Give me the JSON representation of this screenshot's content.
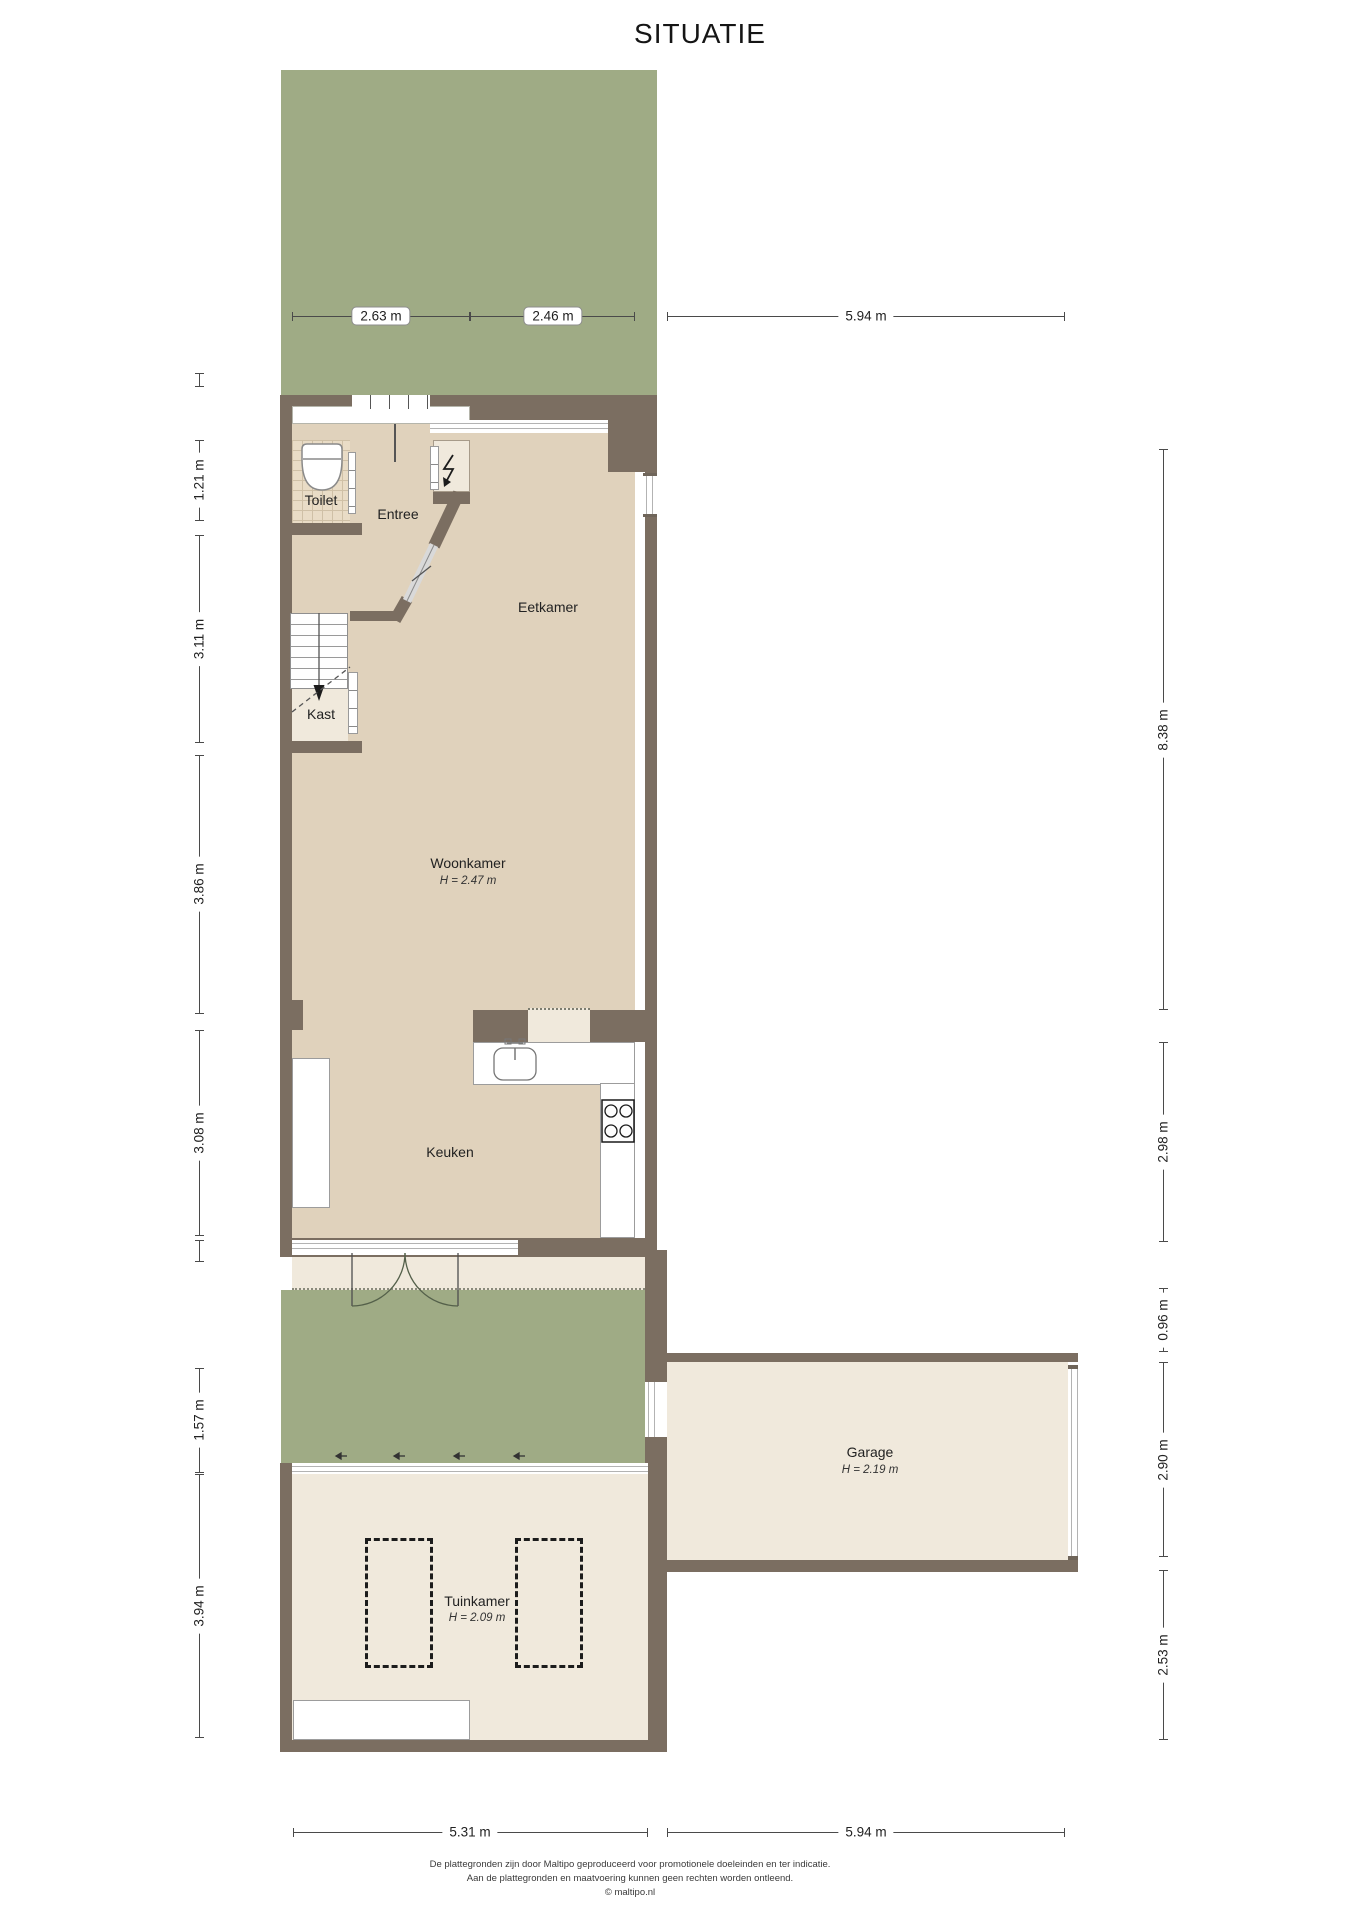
{
  "title": "SITUATIE",
  "rooms": {
    "toilet": {
      "label": "Toilet"
    },
    "entree": {
      "label": "Entree"
    },
    "eetkamer": {
      "label": "Eetkamer"
    },
    "kast": {
      "label": "Kast"
    },
    "woonkamer": {
      "label": "Woonkamer",
      "height_label": "H = 2.47 m"
    },
    "keuken": {
      "label": "Keuken"
    },
    "tuinkamer": {
      "label": "Tuinkamer",
      "height_label": "H = 2.09 m"
    },
    "garage": {
      "label": "Garage",
      "height_label": "H = 2.19 m"
    }
  },
  "dimensions": {
    "top": [
      {
        "label": "2.63 m"
      },
      {
        "label": "2.46 m"
      },
      {
        "label": "5.94 m"
      }
    ],
    "left": [
      {
        "label": "1.21 m"
      },
      {
        "label": "3.11 m"
      },
      {
        "label": "3.86 m"
      },
      {
        "label": "3.08 m"
      },
      {
        "label": "1.57 m"
      },
      {
        "label": "3.94 m"
      }
    ],
    "right": [
      {
        "label": "8.38 m"
      },
      {
        "label": "2.98 m"
      },
      {
        "label": "0.96 m"
      },
      {
        "label": "2.90 m"
      },
      {
        "label": "2.53 m"
      }
    ],
    "bottom": [
      {
        "label": "5.31 m"
      },
      {
        "label": "5.94 m"
      }
    ]
  },
  "footer": {
    "line1": "De plattegronden zijn door Maltipo geproduceerd voor promotionele doeleinden en ter indicatie.",
    "line2": "Aan de plattegronden en maatvoering kunnen geen rechten worden ontleend.",
    "line3": "© maltipo.nl"
  },
  "colors": {
    "garden_green": "#9fab85",
    "wall_brown": "#7b6e61",
    "floor_beige": "#e0d2bc",
    "floor_cream": "#f0e9dc",
    "tile_beige": "#e9dcc6",
    "dim_line": "#4a4a4a"
  },
  "icons": {
    "power_meter": "lightning",
    "stairs_direction": "arrow-down"
  }
}
